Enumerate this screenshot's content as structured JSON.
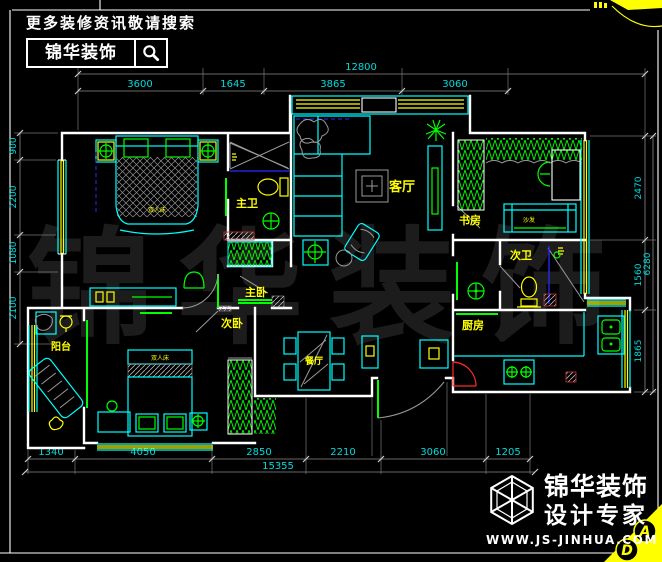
{
  "header": {
    "tagline": "更多装修资讯敬请搜索",
    "brand": "锦华装饰"
  },
  "footer": {
    "brand": "锦华装饰",
    "subtitle": "设计专家",
    "website": "WWW.JS-JINHUA.COM"
  },
  "watermark": {
    "chars": [
      "锦",
      "华",
      "装",
      "饰"
    ]
  },
  "rooms": {
    "living": "客厅",
    "master_bath": "主卫",
    "master_bedroom": "主卧",
    "second_bedroom": "次卧",
    "dining": "餐厅",
    "balcony": "阳台",
    "study": "书房",
    "second_bath": "次卫",
    "kitchen": "厨房"
  },
  "furniture_labels": {
    "sofa": "沙发",
    "master_bed": "双人床",
    "second_bed": "双人床"
  },
  "dimensions": {
    "top": {
      "total": "12800",
      "segments": [
        "3600",
        "1645",
        "3865",
        "3060"
      ]
    },
    "bottom": {
      "total": "15355",
      "segments": [
        "1340",
        "4050",
        "2850",
        "2210",
        "3060",
        "1205"
      ]
    },
    "right": {
      "total": "6280",
      "segments": [
        "2470",
        "1560",
        "1865"
      ]
    },
    "left": {
      "segments": [
        "900",
        "2200",
        "1080",
        "2100"
      ]
    }
  },
  "markers": {
    "elevation_a": "A",
    "elevation_d": "D"
  }
}
